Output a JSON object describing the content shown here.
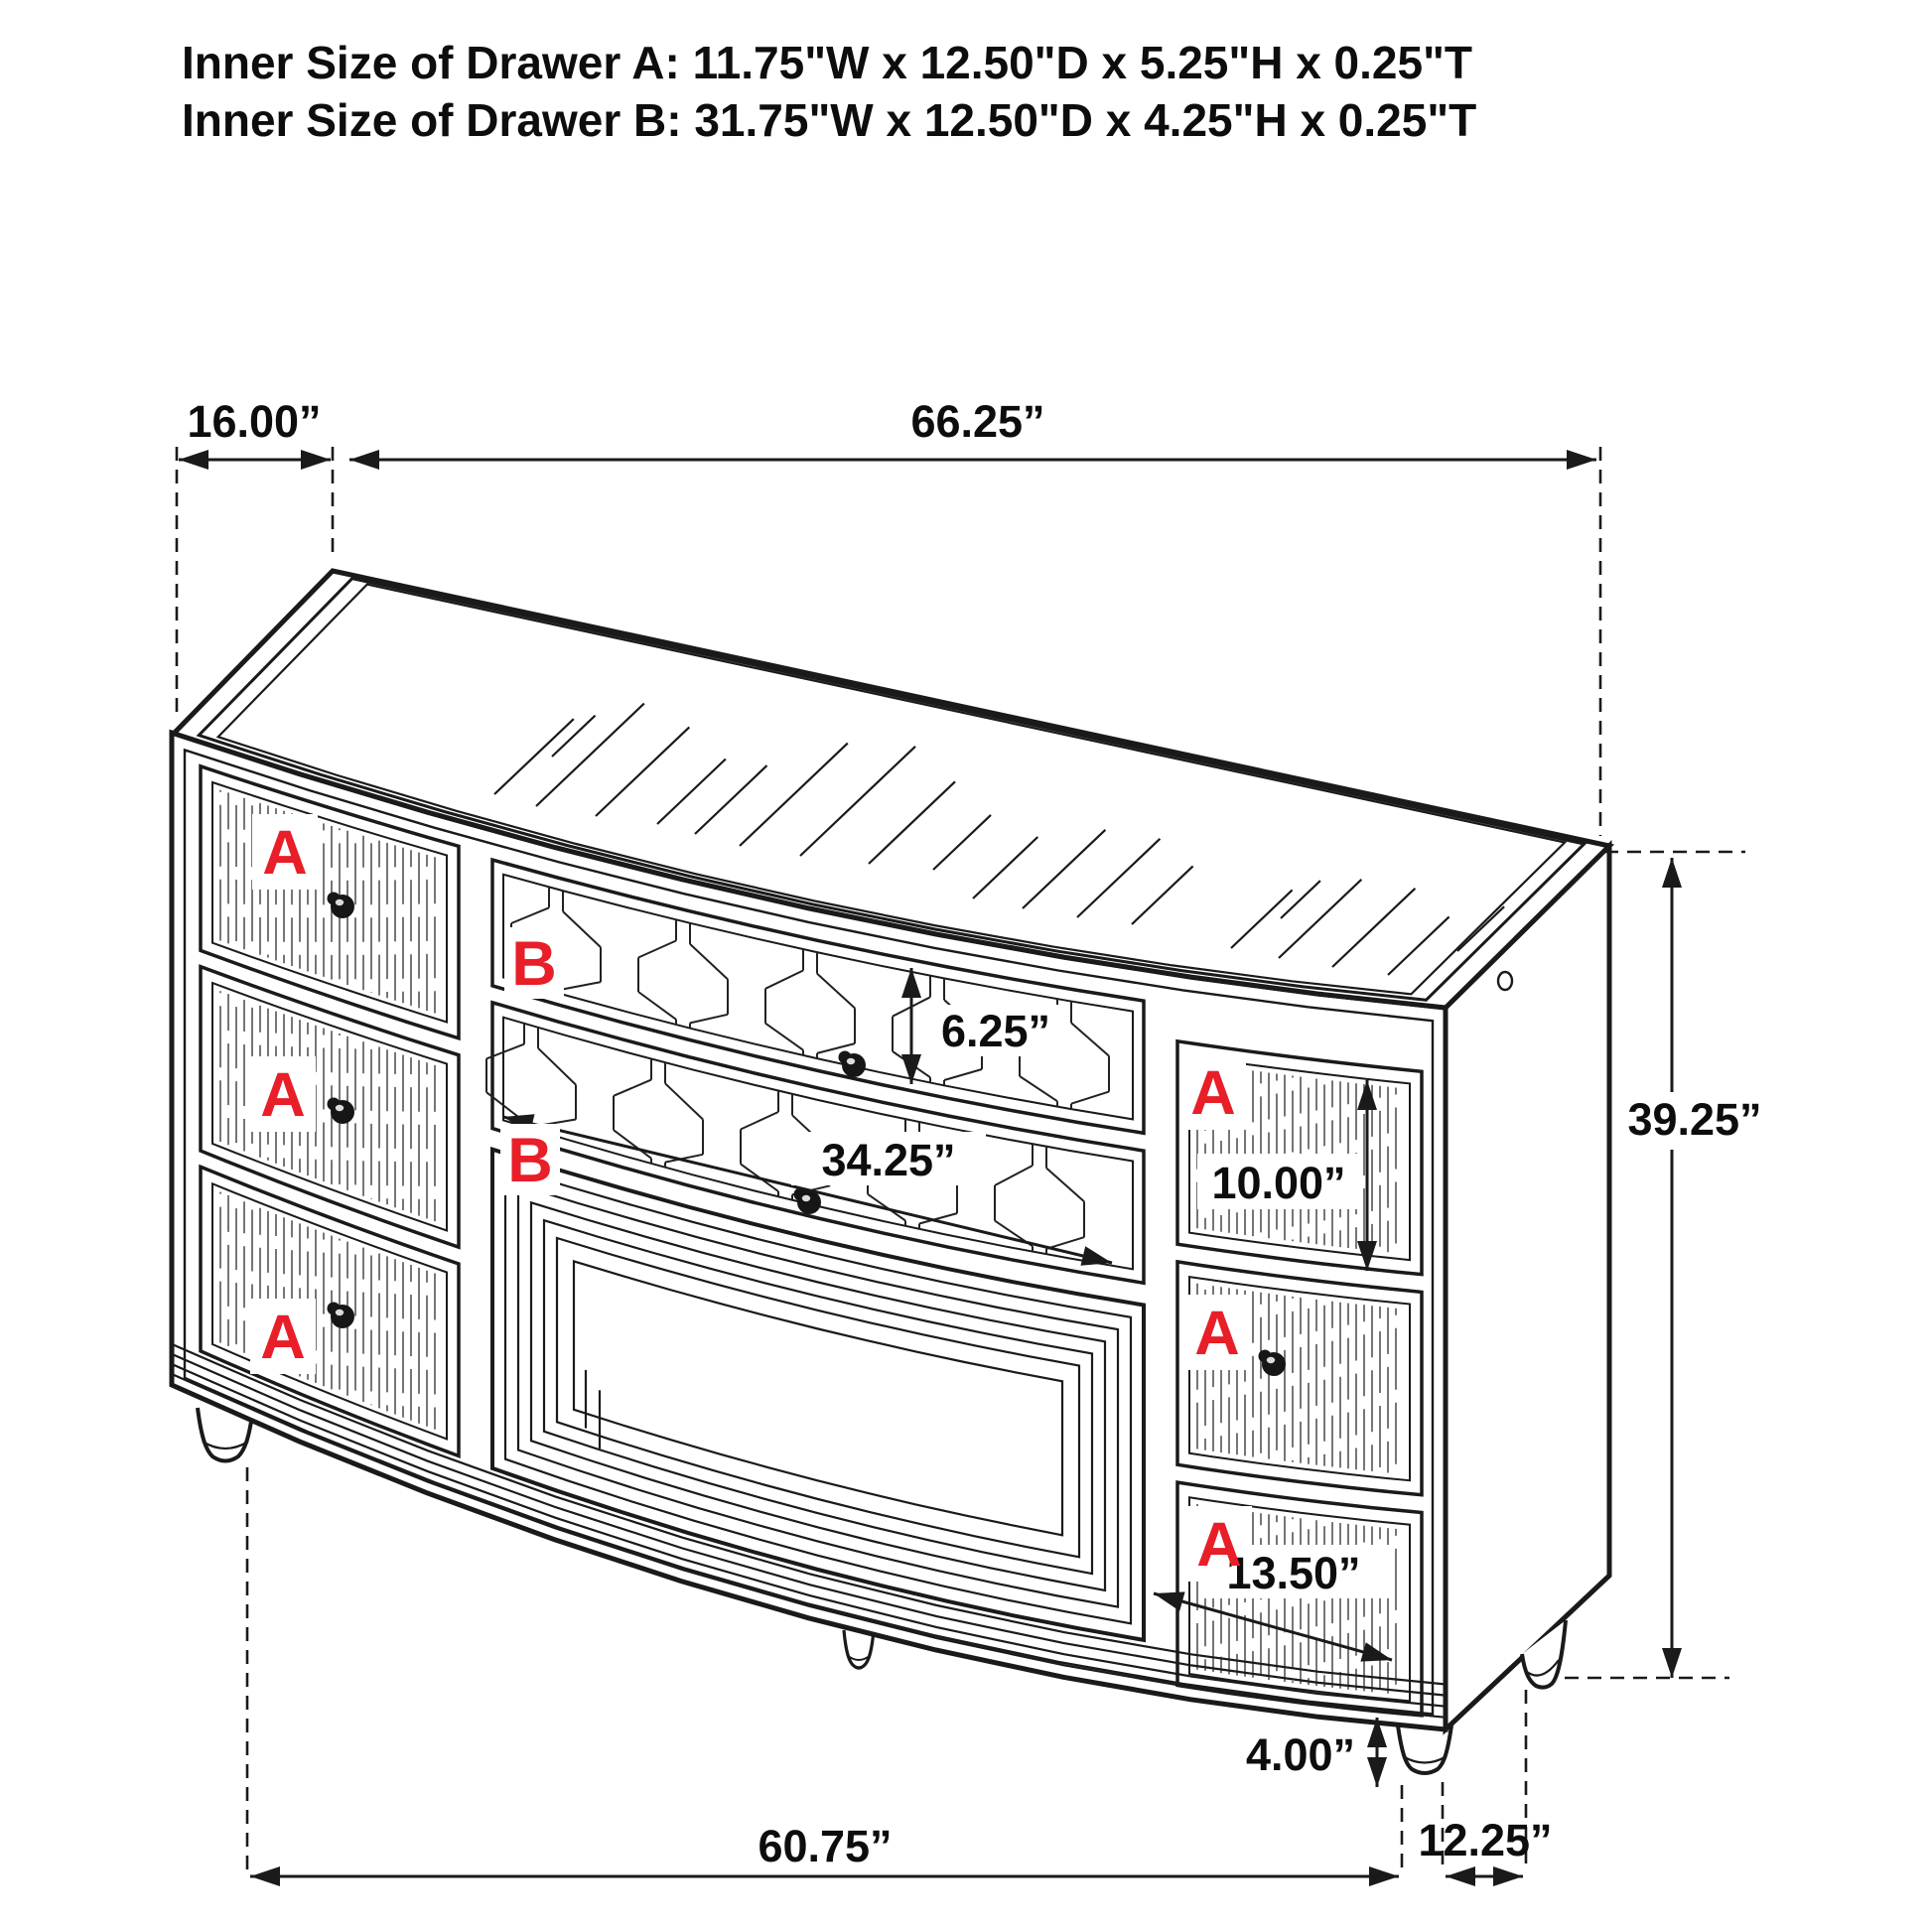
{
  "title": {
    "line1": "Inner Size of Drawer A: 11.75\"W x 12.50\"D x 5.25\"H x 0.25\"T",
    "line2": "Inner Size of Drawer B: 31.75\"W x 12.50\"D x 4.25\"H x 0.25\"T"
  },
  "drawer_labels": {
    "a": "A",
    "b": "B"
  },
  "dimensions": {
    "top_depth": "16.00”",
    "top_width": "66.25”",
    "drawer_b_height": "6.25”",
    "drawer_b_width": "34.25”",
    "right_top_drawer_height": "10.00”",
    "overall_height": "39.25”",
    "right_bottom_drawer_width": "13.50”",
    "leg_height": "4.00”",
    "base_width": "60.75”",
    "base_depth": "12.25”"
  },
  "colors": {
    "line": "#1a1a1a",
    "label_red": "#e81e28",
    "background": "#ffffff"
  }
}
